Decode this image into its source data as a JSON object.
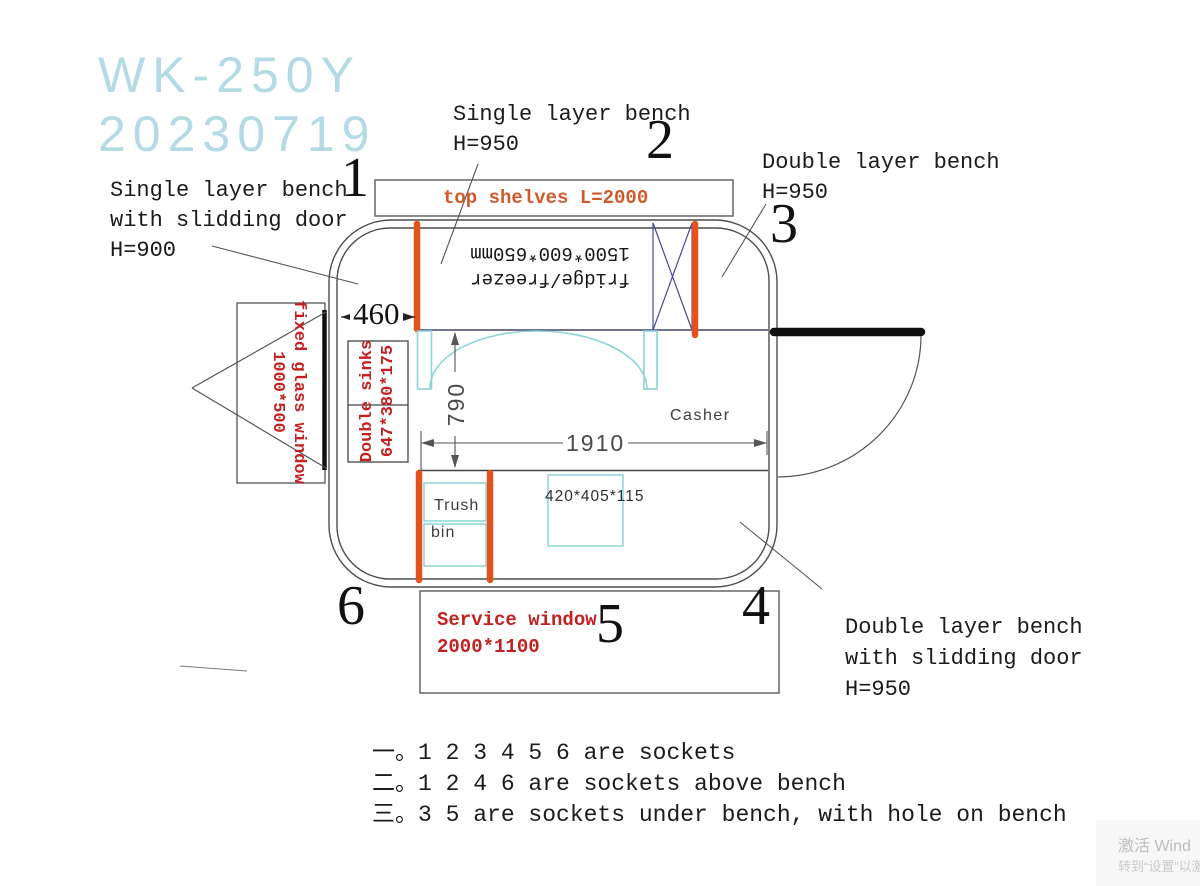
{
  "title": {
    "model": "WK-250Y",
    "date": "20230719"
  },
  "annotations": {
    "bench_top_left": {
      "l1": "Single layer bench",
      "l2": "with slidding door",
      "l3": "H=900"
    },
    "bench_top": {
      "l1": "Single layer bench",
      "l2": "H=950"
    },
    "bench_right": {
      "l1": "Double layer bench",
      "l2": "H=950"
    },
    "bench_bottom_right": {
      "l1": "Double layer bench",
      "l2": "with slidding door",
      "l3": "H=950"
    },
    "top_shelves": "top shelves L=2000",
    "fridge": {
      "l1": "fridge/freezer",
      "l2": "1500*600*650mm"
    },
    "fixed_glass_window": {
      "l1": "fixed glass window",
      "l2": "1000*500"
    },
    "double_sinks": {
      "l1": "Double sinks",
      "l2": "647*380*175"
    },
    "casher": "Casher",
    "trush_bin": {
      "l1": "Trush",
      "l2": "bin"
    },
    "box_420": "420*405*115",
    "service_window": {
      "l1": "Service window",
      "l2": "2000*1100"
    }
  },
  "dimensions": {
    "d460": "460",
    "d790": "790",
    "d1910": "1910"
  },
  "socket_markers": {
    "n1": "1",
    "n2": "2",
    "n3": "3",
    "n4": "4",
    "n5": "5",
    "n6": "6"
  },
  "notes": {
    "l1": "一。1 2 3 4 5 6 are sockets",
    "l2": "二。1 2 4 6 are sockets above bench",
    "l3": "三。3 5 are sockets under bench, with hole on bench"
  },
  "watermark": {
    "l1": "激活 Wind",
    "l2": "转到“设置”以激"
  },
  "colors": {
    "socket_orange": "#e2521c",
    "annotation_red": "#c32121",
    "shelf_orange": "#d05a2a",
    "cyan_fixture": "#8ed4d6",
    "navy_brace": "#4747a3",
    "title_cyan": "#b4dbe5",
    "wall_gray": "#4d4d4d"
  }
}
